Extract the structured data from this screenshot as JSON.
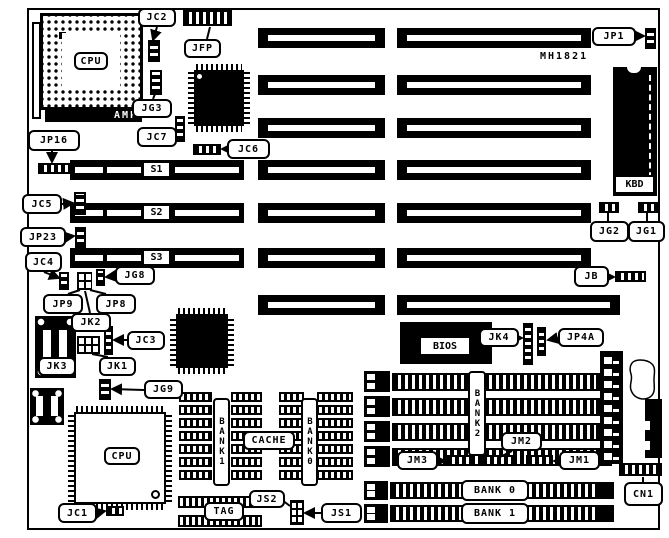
{
  "board": {
    "model": "MH1821",
    "cpu_socket_label": "CPU",
    "cpu_chip_label": "CPU",
    "amp_label": "AMP",
    "kbd_label": "KBD",
    "bios_label": "BIOS",
    "cache_label": "CACHE",
    "tag_label": "TAG"
  },
  "slots": {
    "s1": "S1",
    "s2": "S2",
    "s3": "S3",
    "bank0": "BANK 0",
    "bank1": "BANK 1"
  },
  "memory": {
    "cache_bank1": "BANK1",
    "cache_bank0": "BANK0",
    "simm_bank2": "BANK2"
  },
  "jumpers": {
    "jc1": "JC1",
    "jc2": "JC2",
    "jc3": "JC3",
    "jc4": "JC4",
    "jc5": "JC5",
    "jc6": "JC6",
    "jc7": "JC7",
    "jg1": "JG1",
    "jg2": "JG2",
    "jg3": "JG3",
    "jg8": "JG8",
    "jg9": "JG9",
    "jp1": "JP1",
    "jp8": "JP8",
    "jp9": "JP9",
    "jp16": "JP16",
    "jp23": "JP23",
    "jp4a": "JP4A",
    "jb": "JB",
    "jfp": "JFP",
    "jk1": "JK1",
    "jk2": "JK2",
    "jk3": "JK3",
    "jk4": "JK4",
    "jm1": "JM1",
    "jm2": "JM2",
    "jm3": "JM3",
    "js1": "JS1",
    "js2": "JS2",
    "cn1": "CN1"
  }
}
